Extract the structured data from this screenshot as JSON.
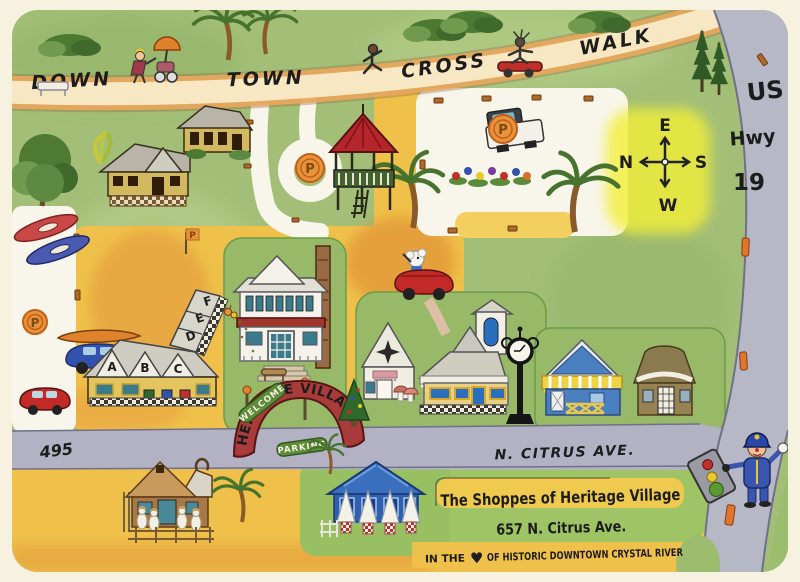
{
  "map_title": "The Shoppes of Heritage Village map",
  "crosswalk": {
    "w1": "DOWN",
    "w2": "TOWN",
    "w3": "CROSS",
    "w4": "WALK"
  },
  "highway": {
    "us": "US",
    "hwy": "Hwy",
    "num": "19"
  },
  "compass": {
    "top": "E",
    "left": "N",
    "right": "S",
    "bottom": "W"
  },
  "roads": {
    "route495": "495",
    "citrus": "N. CITRUS AVE."
  },
  "banner": {
    "welcome": "WELCOME",
    "heritage": "HERITAGE VILLAGE",
    "parking": "PARKING"
  },
  "parking": {
    "p": "P"
  },
  "shops": {
    "a": "A",
    "b": "B",
    "c": "C",
    "d": "D",
    "e": "E",
    "f": "F"
  },
  "infobox": {
    "line1": "The Shoppes of Heritage Village",
    "line2": "657 N. Citrus Ave.",
    "line3_pre": "IN THE",
    "heart": "♥",
    "line3_post": "OF HISTORIC DOWNTOWN CRYSTAL RIVER"
  },
  "colors": {
    "paper": "#f7f2df",
    "map_green": "#a3bf77",
    "road_gray": "#b6b8c6",
    "path_tan": "#f7e7c3",
    "path_orange_edge": "#eba75c",
    "parking_yellow": "#efc14a",
    "banner_red": "#a93b3b",
    "ribbon_green": "#5f8c3a",
    "p_circle_orange": "#e8923c",
    "compass_highlight": "#f3ef38",
    "heart_red": "#cc1122"
  }
}
